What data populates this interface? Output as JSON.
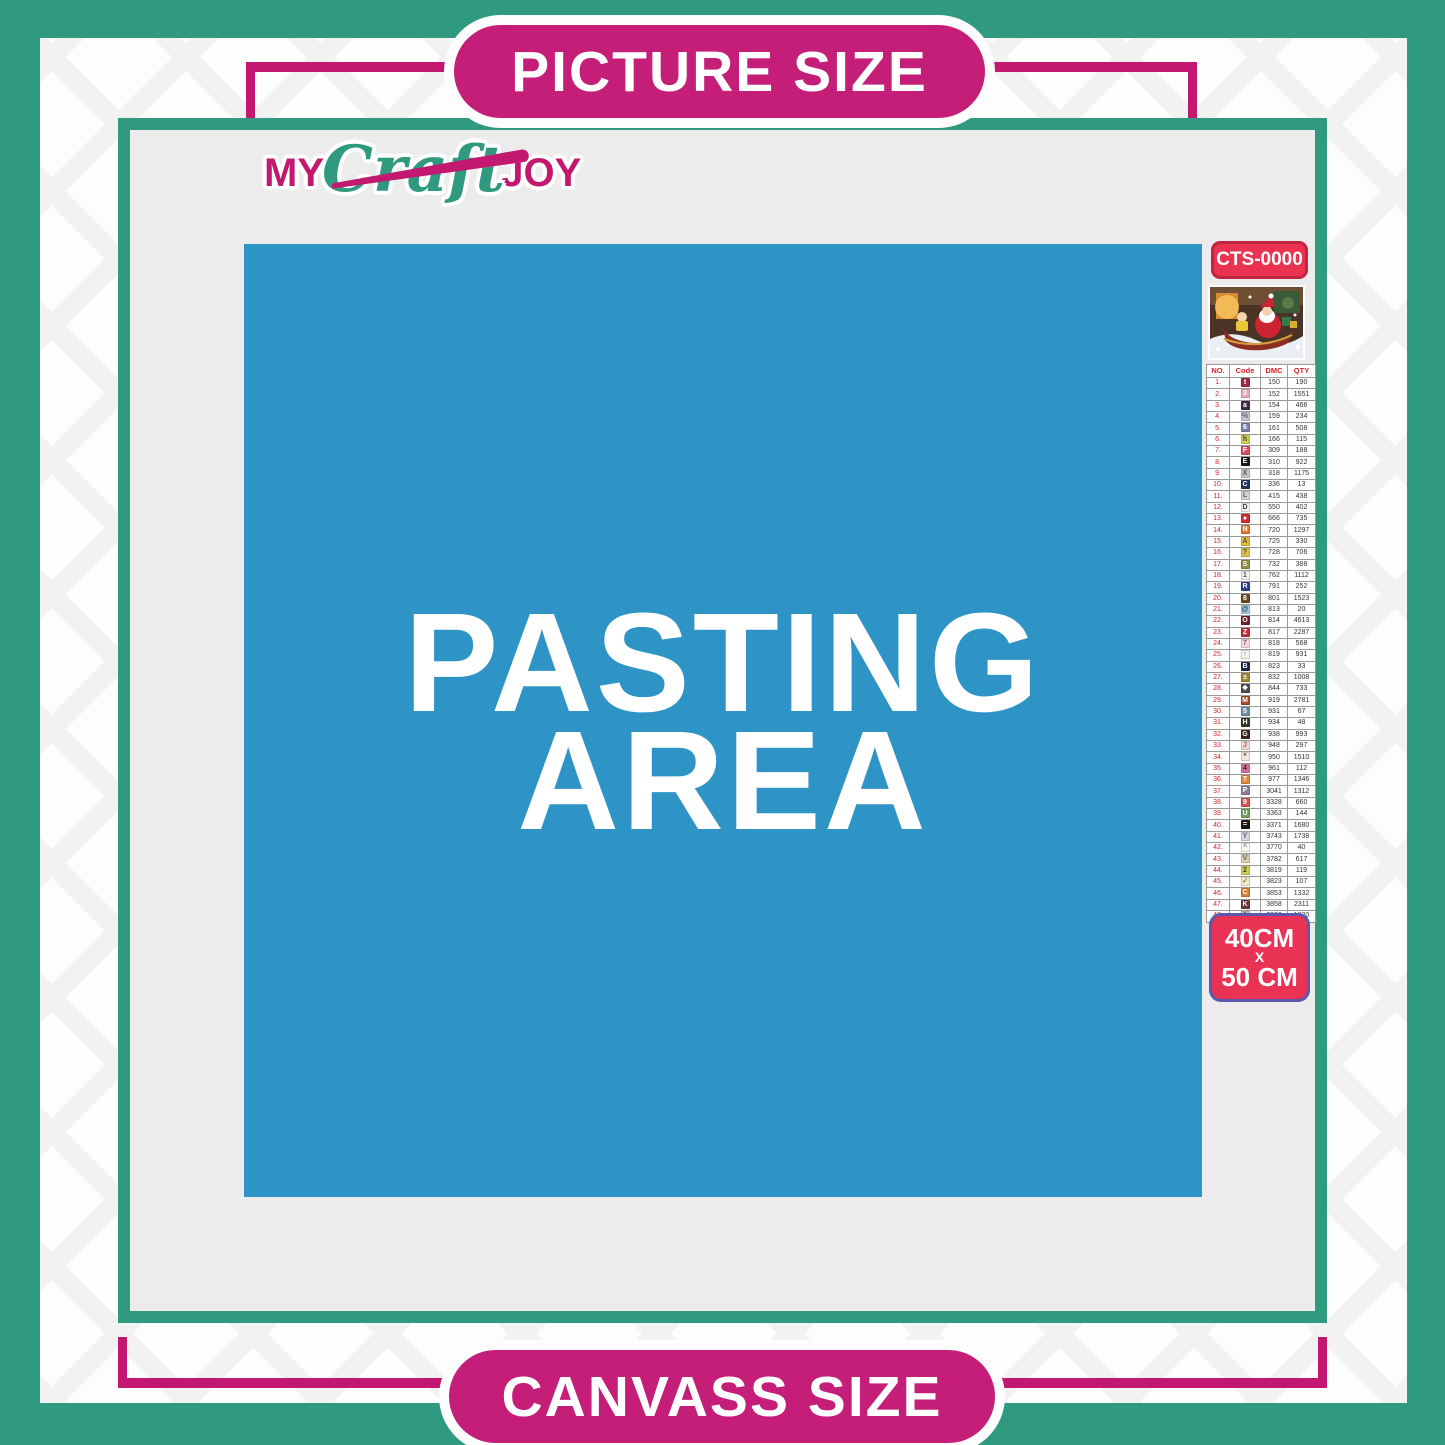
{
  "labels": {
    "top": "PICTURE SIZE",
    "bottom": "CANVASS SIZE"
  },
  "logo": {
    "part1": "MY",
    "part2": "Craft",
    "part3": "JOY"
  },
  "pasting_area": {
    "line1": "PASTING",
    "line2": "AREA"
  },
  "legend": {
    "code": "CTS-0000",
    "thumbnail_icon": "christmas-santa-sleigh-artwork",
    "size_badge": {
      "line1": "40CM",
      "line2": "X",
      "line3": "50 CM"
    },
    "table": {
      "headers": [
        "NO.",
        "Code",
        "DMC",
        "QTY"
      ],
      "row_fields": [
        "no",
        "symbol",
        "chip_bg",
        "chip_fg",
        "dmc",
        "qty"
      ],
      "rows": [
        [
          "1.",
          "t",
          "#9C2B3F",
          "#FFFFFF",
          "150",
          "190"
        ],
        [
          "2.",
          "3",
          "#E2ABB5",
          "#FFFFFF",
          "152",
          "1551"
        ],
        [
          "3.",
          "a",
          "#46284A",
          "#FFFFFF",
          "154",
          "466"
        ],
        [
          "4.",
          "%",
          "#C8C4D9",
          "#666677",
          "159",
          "234"
        ],
        [
          "5.",
          "6",
          "#7A82AE",
          "#FFFFFF",
          "161",
          "508"
        ],
        [
          "6.",
          "h",
          "#CCD14E",
          "#444433",
          "166",
          "115"
        ],
        [
          "7.",
          "F",
          "#D94E60",
          "#FFFFFF",
          "309",
          "188"
        ],
        [
          "8.",
          "E",
          "#181818",
          "#FFFFFF",
          "310",
          "922"
        ],
        [
          "9.",
          "X",
          "#C6C6CB",
          "#555555",
          "318",
          "1175"
        ],
        [
          "10.",
          "C",
          "#22335F",
          "#FFFFFF",
          "336",
          "13"
        ],
        [
          "11.",
          "L",
          "#D2D2D5",
          "#666666",
          "415",
          "438"
        ],
        [
          "12.",
          "D",
          "#F4F1F6",
          "#444444",
          "550",
          "402"
        ],
        [
          "13.",
          "●",
          "#D42A33",
          "#FFFFFF",
          "666",
          "735"
        ],
        [
          "14.",
          "N",
          "#E07B36",
          "#FFFFFF",
          "720",
          "1297"
        ],
        [
          "15.",
          "A",
          "#E6BA3F",
          "#555533",
          "725",
          "330"
        ],
        [
          "16.",
          "?",
          "#DDC14E",
          "#555533",
          "728",
          "706"
        ],
        [
          "17.",
          "S",
          "#8F8F3D",
          "#FFFFFF",
          "732",
          "388"
        ],
        [
          "18.",
          "1",
          "#F1F1F1",
          "#555555",
          "762",
          "1112"
        ],
        [
          "19.",
          "R",
          "#2C3F8A",
          "#FFFFFF",
          "791",
          "252"
        ],
        [
          "20.",
          "8",
          "#6E4A22",
          "#FFFFFF",
          "801",
          "1523"
        ],
        [
          "21.",
          "@",
          "#A9CBE2",
          "#334455",
          "813",
          "20"
        ],
        [
          "22.",
          "O",
          "#6D1F2C",
          "#FFFFFF",
          "814",
          "4613"
        ],
        [
          "23.",
          "Z",
          "#C2303C",
          "#FFFFFF",
          "817",
          "2287"
        ],
        [
          "24.",
          "7",
          "#F2D7DC",
          "#996666",
          "818",
          "568"
        ],
        [
          "25.",
          "↑",
          "#F6F0EA",
          "#777777",
          "819",
          "931"
        ],
        [
          "26.",
          "B",
          "#1C2749",
          "#FFFFFF",
          "823",
          "33"
        ],
        [
          "27.",
          "±",
          "#9D8836",
          "#FFFFFF",
          "832",
          "1008"
        ],
        [
          "28.",
          "❖",
          "#4C4F4A",
          "#FFFFFF",
          "844",
          "733"
        ],
        [
          "29.",
          "M",
          "#A54A2A",
          "#FFFFFF",
          "919",
          "2781"
        ],
        [
          "30.",
          "5",
          "#6F8FA8",
          "#FFFFFF",
          "931",
          "67"
        ],
        [
          "31.",
          "H",
          "#2E3B2A",
          "#FFFFFF",
          "934",
          "48"
        ],
        [
          "32.",
          "G",
          "#3B2618",
          "#FFFFFF",
          "938",
          "993"
        ],
        [
          "33.",
          "J",
          "#F4DACD",
          "#996666",
          "948",
          "297"
        ],
        [
          "34.",
          "*",
          "#F0E8DC",
          "#333333",
          "950",
          "1510"
        ],
        [
          "35.",
          "4",
          "#D4729B",
          "#442233",
          "961",
          "112"
        ],
        [
          "36.",
          "T",
          "#E08A3C",
          "#FFFFFF",
          "977",
          "1346"
        ],
        [
          "37.",
          "P",
          "#8B7F9B",
          "#FFFFFF",
          "3041",
          "1312"
        ],
        [
          "38.",
          "9",
          "#D4554C",
          "#FFFFFF",
          "3328",
          "660"
        ],
        [
          "39.",
          "U",
          "#6FA05A",
          "#FFFFFF",
          "3363",
          "144"
        ],
        [
          "40.",
          "=",
          "#1E1710",
          "#FFFFFF",
          "3371",
          "1680"
        ],
        [
          "41.",
          "Y",
          "#D8D4E4",
          "#666666",
          "3743",
          "1738"
        ],
        [
          "42.",
          "^",
          "#F8F6F1",
          "#888888",
          "3770",
          "40"
        ],
        [
          "43.",
          "V",
          "#DCC9AE",
          "#776655",
          "3782",
          "617"
        ],
        [
          "44.",
          "2",
          "#CCD14D",
          "#444433",
          "3819",
          "119"
        ],
        [
          "45.",
          "✓",
          "#F3ECCB",
          "#777766",
          "3823",
          "107"
        ],
        [
          "46.",
          "C",
          "#D97E2E",
          "#FFFFFF",
          "3853",
          "1332"
        ],
        [
          "47.",
          "K",
          "#6E3B34",
          "#FFFFFF",
          "3858",
          "2311"
        ],
        [
          "48.",
          "A",
          "#CFC1AF",
          "#665544",
          "3863",
          "1820"
        ]
      ]
    }
  },
  "colors": {
    "teal": "#2F9A80",
    "magenta": "#C2186F",
    "pill_magenta": "#C51E78",
    "blue": "#2E94C6",
    "panel_gray": "#ECECEC",
    "cts_red": "#E93350",
    "cts_border": "#C0273F",
    "size_red": "#E93355",
    "size_border": "#5B58AE",
    "table_red": "#D4232B"
  }
}
